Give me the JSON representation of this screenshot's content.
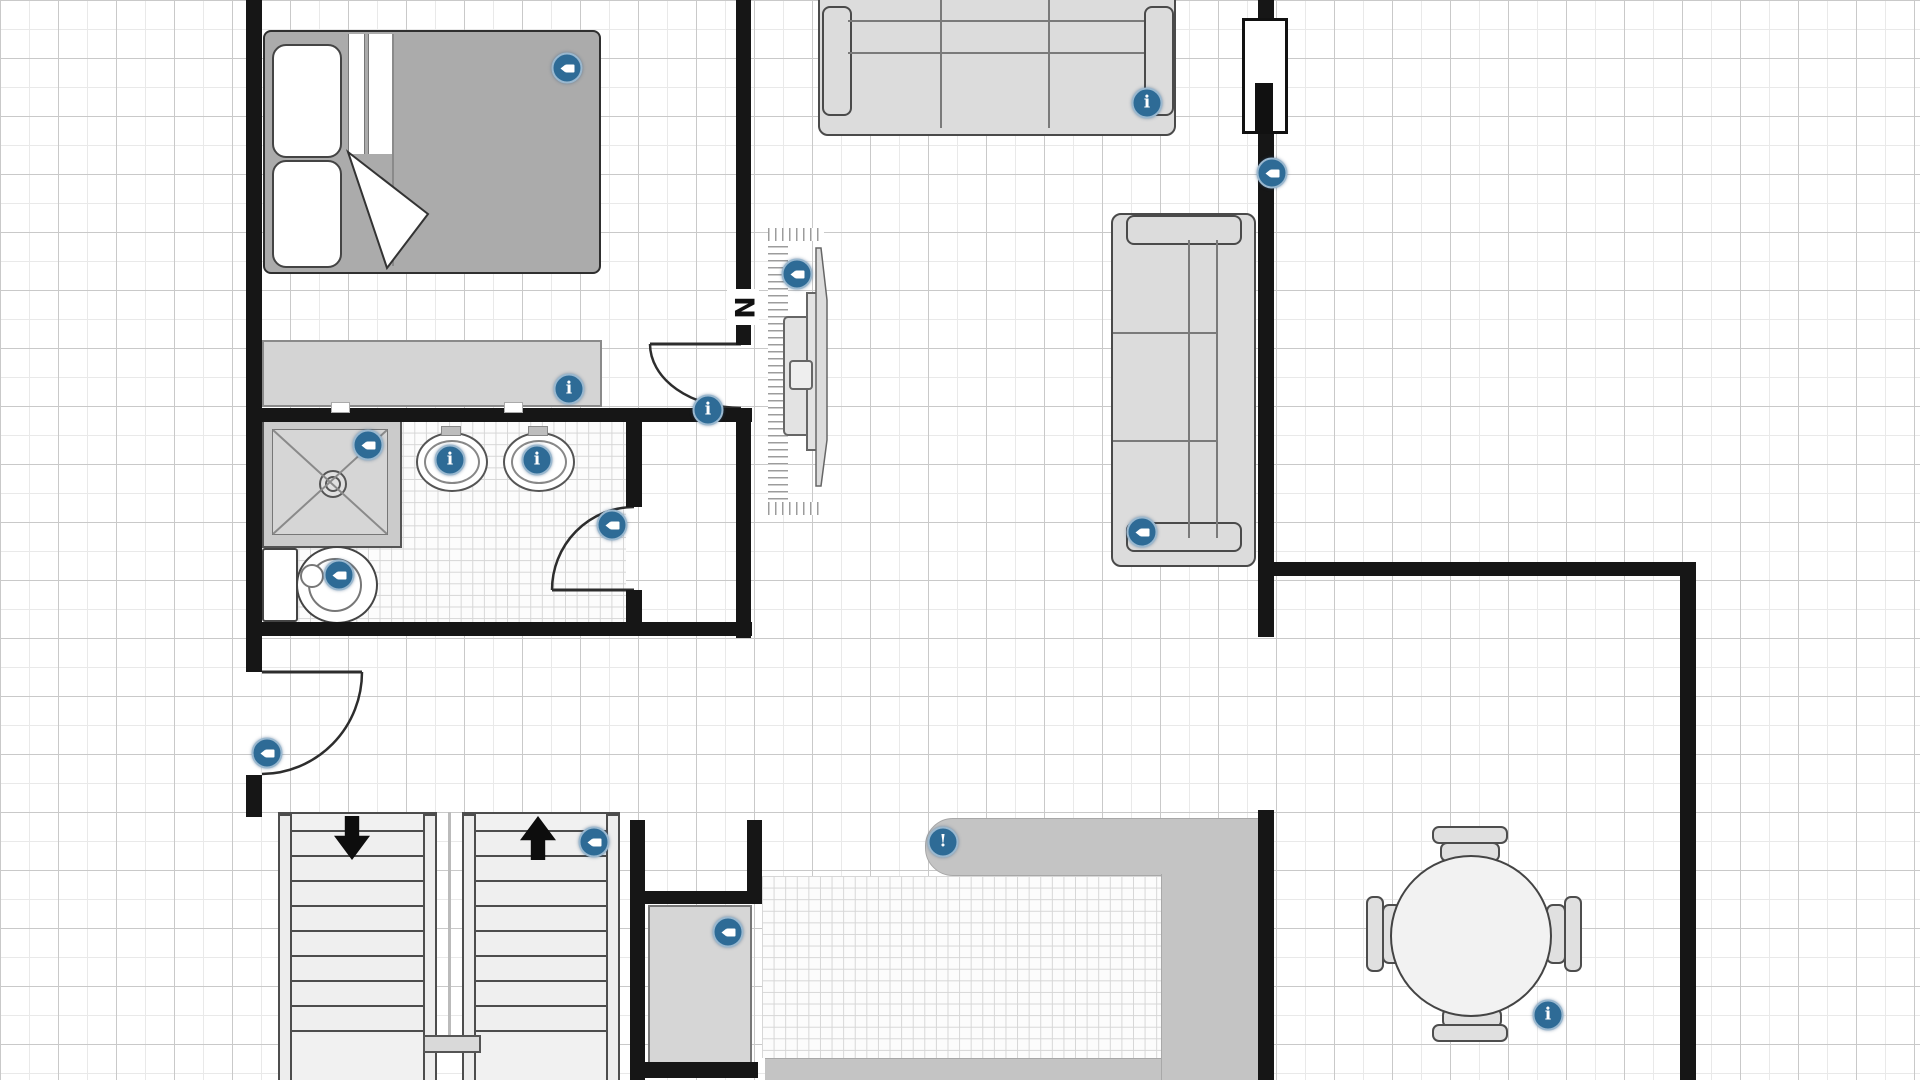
{
  "plan": {
    "north_label": "N"
  },
  "glyphs": {
    "info": "i",
    "alert": "!"
  },
  "colors": {
    "wall": "#161616",
    "marker_blue": "#2e6b96",
    "furniture_fill": "#dcdcdc",
    "furniture_line": "#4a4a4a",
    "counter_gray": "#c4c4c4",
    "bed_blanket": "#ababab",
    "grid_major": "#c9c9c9",
    "grid_minor": "#e9e9e9"
  },
  "rooms": {
    "bedroom_items": [
      "double-bed",
      "dresser"
    ],
    "bathroom_items": [
      "shower",
      "sink",
      "sink",
      "toilet"
    ],
    "living_items": [
      "sofa-3-seat-top",
      "sofa-3-seat-right",
      "wall-tv-fireplace",
      "window"
    ],
    "kitchen_items": [
      "counter",
      "cabinet"
    ],
    "dining_items": [
      "round-table",
      "chair",
      "chair",
      "chair",
      "chair"
    ],
    "circulation_items": [
      "stairs-down",
      "stairs-up",
      "entry-door",
      "bedroom-door",
      "bathroom-door"
    ]
  },
  "markers": [
    {
      "id": "bed",
      "type": "camera",
      "x": 567,
      "y": 68,
      "label": "camera view: bed"
    },
    {
      "id": "dresser",
      "type": "info",
      "x": 569,
      "y": 389,
      "label": "info: dresser"
    },
    {
      "id": "shower",
      "type": "camera",
      "x": 368,
      "y": 445,
      "label": "camera view: shower"
    },
    {
      "id": "sink-left",
      "type": "info",
      "x": 450,
      "y": 460,
      "label": "info: sink"
    },
    {
      "id": "sink-right",
      "type": "info",
      "x": 537,
      "y": 460,
      "label": "info: sink"
    },
    {
      "id": "toilet",
      "type": "camera",
      "x": 339,
      "y": 575,
      "label": "camera view: toilet"
    },
    {
      "id": "bathroom-door",
      "type": "camera",
      "x": 612,
      "y": 525,
      "label": "camera view: bathroom door"
    },
    {
      "id": "hallway-wall",
      "type": "info",
      "x": 708,
      "y": 410,
      "label": "info: hallway wall"
    },
    {
      "id": "fireplace",
      "type": "camera",
      "x": 797,
      "y": 274,
      "label": "camera view: fireplace tv"
    },
    {
      "id": "sofa-top",
      "type": "info",
      "x": 1147,
      "y": 103,
      "label": "info: sofa"
    },
    {
      "id": "living-window",
      "type": "camera",
      "x": 1272,
      "y": 173,
      "label": "camera view: living room window"
    },
    {
      "id": "sofa-right",
      "type": "camera",
      "x": 1142,
      "y": 532,
      "label": "camera view: sofa"
    },
    {
      "id": "kitchen-counter",
      "type": "alert",
      "x": 943,
      "y": 842,
      "label": "alert: kitchen counter"
    },
    {
      "id": "stairs",
      "type": "camera",
      "x": 594,
      "y": 842,
      "label": "camera view: stairs"
    },
    {
      "id": "cabinet",
      "type": "camera",
      "x": 728,
      "y": 932,
      "label": "camera view: cabinet"
    },
    {
      "id": "entry-door",
      "type": "camera",
      "x": 267,
      "y": 753,
      "label": "camera view: entry door"
    },
    {
      "id": "dining-table",
      "type": "info",
      "x": 1548,
      "y": 1015,
      "label": "info: dining table"
    }
  ]
}
